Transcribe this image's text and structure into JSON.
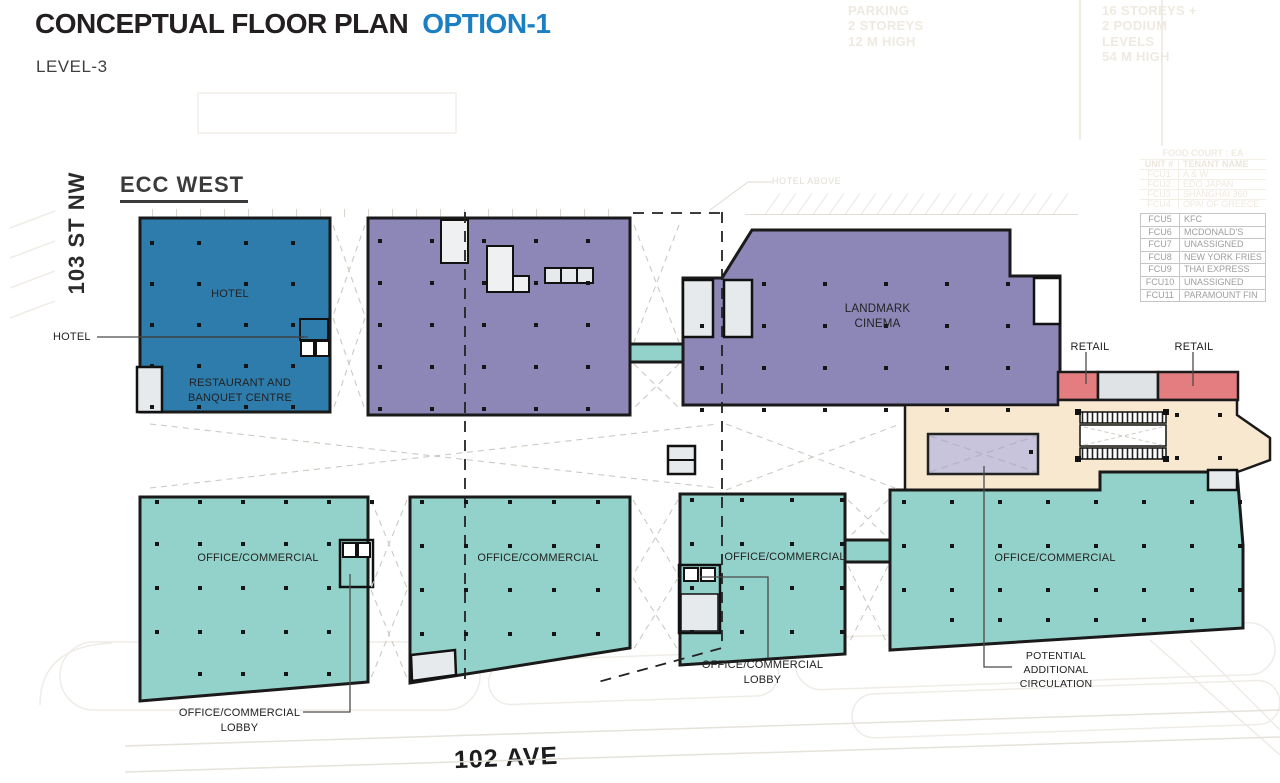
{
  "header": {
    "title": "CONCEPTUAL FLOOR PLAN",
    "option": "OPTION-1",
    "level": "LEVEL-3"
  },
  "site": {
    "name": "ECC WEST"
  },
  "streets": {
    "west": "103 ST NW",
    "south": "102 AVE"
  },
  "palette": {
    "accent": "#1b7fc4",
    "hotel": "#2d7cac",
    "podium": "#8d87b8",
    "cinema": "#8d87b8",
    "office": "#93d2ca",
    "retail": "#e37d7f",
    "circulation": "#f8e8d0",
    "potential_circulation": "#c7c4db",
    "fixture_gray": "#e7eaec"
  },
  "regions": {
    "hotel": "HOTEL",
    "restaurant": "RESTAURANT AND\nBANQUET CENTRE",
    "cinema": "LANDMARK\nCINEMA",
    "offices": [
      "OFFICE/COMMERCIAL",
      "OFFICE/COMMERCIAL",
      "OFFICE/COMMERCIAL",
      "OFFICE/COMMERCIAL"
    ],
    "retail": [
      "RETAIL",
      "RETAIL"
    ]
  },
  "callouts": {
    "hotel": "HOTEL",
    "lobby_west": "OFFICE/COMMERCIAL\nLOBBY",
    "lobby_central": "OFFICE/COMMERCIAL\nLOBBY",
    "potential_circulation": "POTENTIAL\nADDITIONAL\nCIRCULATION",
    "hotel_above": "HOTEL ABOVE"
  },
  "context_notes": {
    "parking": "PARKING\n2 STOREYS\n12 M HIGH",
    "tower": "16 STOREYS +\n2 PODIUM\nLEVELS\n54 M HIGH"
  },
  "food_court": {
    "title": "FOOD COURT : EA",
    "headers": [
      "UNIT #",
      "TENANT NAME"
    ],
    "faint_rows": [
      [
        "FCU1",
        "A & W"
      ],
      [
        "FCU2",
        "EDO JAPAN"
      ],
      [
        "FCU3",
        "SHANGHAI 360"
      ],
      [
        "FCU4",
        "OPA! OF GREECE"
      ]
    ],
    "rows": [
      [
        "FCU5",
        "KFC"
      ],
      [
        "FCU6",
        "MCDONALD'S"
      ],
      [
        "FCU7",
        "UNASSIGNED"
      ],
      [
        "FCU8",
        "NEW YORK FRIES"
      ],
      [
        "FCU9",
        "THAI EXPRESS"
      ],
      [
        "FCU10",
        "UNASSIGNED"
      ],
      [
        "FCU11",
        "PARAMOUNT FIN"
      ]
    ]
  }
}
